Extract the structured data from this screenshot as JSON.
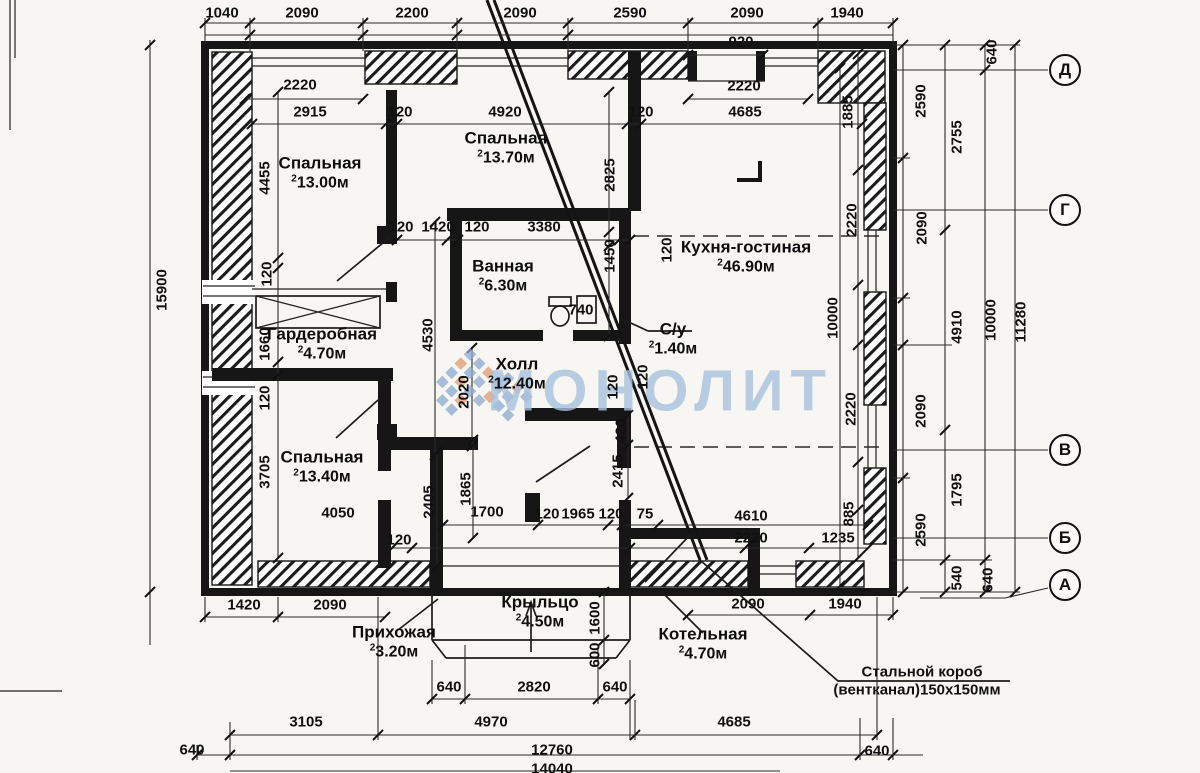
{
  "watermark": {
    "text": "МОНОЛИТ"
  },
  "annotation": {
    "line1": "Стальной короб",
    "line2": "(вентканал)150x150мм"
  },
  "colors": {
    "watermark": "#a9c2de",
    "logo_blue": "#8da9cf",
    "logo_orange": "#e09a74",
    "ink": "#161616"
  },
  "axes": [
    {
      "label": "Д",
      "x": 1065,
      "y": 70
    },
    {
      "label": "Г",
      "x": 1065,
      "y": 210
    },
    {
      "label": "В",
      "x": 1065,
      "y": 450
    },
    {
      "label": "Б",
      "x": 1065,
      "y": 538
    },
    {
      "label": "А",
      "x": 1065,
      "y": 585
    }
  ],
  "rooms": [
    {
      "name": "Спальная",
      "area": "13.00м",
      "x": 320,
      "y": 173
    },
    {
      "name": "Спальная",
      "area": "13.70м",
      "x": 506,
      "y": 148
    },
    {
      "name": "Кухня-гостиная",
      "area": "46.90м",
      "x": 746,
      "y": 257
    },
    {
      "name": "Ванная",
      "area": "6.30м",
      "x": 503,
      "y": 276
    },
    {
      "name": "С/у",
      "area": "1.40м",
      "x": 673,
      "y": 339
    },
    {
      "name": "Холл",
      "area": "12.40м",
      "x": 517,
      "y": 374
    },
    {
      "name": "Гардеробная",
      "area": "4.70м",
      "x": 322,
      "y": 344
    },
    {
      "name": "Спальная",
      "area": "13.40м",
      "x": 322,
      "y": 467
    },
    {
      "name": "Крыльцо",
      "area": "4.50м",
      "x": 540,
      "y": 612
    },
    {
      "name": "Прихожая",
      "area": "3.20м",
      "x": 394,
      "y": 642
    },
    {
      "name": "Котельная",
      "area": "4.70м",
      "x": 703,
      "y": 644
    }
  ],
  "dimension_labels": [
    {
      "t": "1040",
      "x": 222,
      "y": 13
    },
    {
      "t": "2090",
      "x": 302,
      "y": 13
    },
    {
      "t": "2200",
      "x": 412,
      "y": 13
    },
    {
      "t": "2090",
      "x": 520,
      "y": 13
    },
    {
      "t": "2590",
      "x": 630,
      "y": 13
    },
    {
      "t": "2090",
      "x": 747,
      "y": 13
    },
    {
      "t": "1940",
      "x": 847,
      "y": 13
    },
    {
      "t": "920",
      "x": 741,
      "y": 42
    },
    {
      "t": "2220",
      "x": 300,
      "y": 85
    },
    {
      "t": "2220",
      "x": 744,
      "y": 86
    },
    {
      "t": "2915",
      "x": 310,
      "y": 112
    },
    {
      "t": "120",
      "x": 400,
      "y": 112
    },
    {
      "t": "4920",
      "x": 505,
      "y": 112
    },
    {
      "t": "120",
      "x": 641,
      "y": 112
    },
    {
      "t": "4685",
      "x": 745,
      "y": 112
    },
    {
      "t": "1885",
      "x": 848,
      "y": 112,
      "r": 1
    },
    {
      "t": "640",
      "x": 992,
      "y": 52,
      "r": 1
    },
    {
      "t": "2590",
      "x": 921,
      "y": 101,
      "r": 1
    },
    {
      "t": "2755",
      "x": 957,
      "y": 137,
      "r": 1
    },
    {
      "t": "2090",
      "x": 922,
      "y": 228,
      "r": 1
    },
    {
      "t": "2220",
      "x": 852,
      "y": 220,
      "r": 1
    },
    {
      "t": "2825",
      "x": 610,
      "y": 175,
      "r": 1
    },
    {
      "t": "120",
      "x": 667,
      "y": 250,
      "r": 1
    },
    {
      "t": "15900",
      "x": 162,
      "y": 290,
      "r": 1
    },
    {
      "t": "4455",
      "x": 265,
      "y": 178,
      "r": 1
    },
    {
      "t": "120",
      "x": 267,
      "y": 274,
      "r": 1
    },
    {
      "t": "1660",
      "x": 265,
      "y": 344,
      "r": 1
    },
    {
      "t": "120",
      "x": 265,
      "y": 398,
      "r": 1
    },
    {
      "t": "3705",
      "x": 265,
      "y": 472,
      "r": 1
    },
    {
      "t": "120",
      "x": 401,
      "y": 227
    },
    {
      "t": "1420",
      "x": 438,
      "y": 227
    },
    {
      "t": "120",
      "x": 477,
      "y": 227
    },
    {
      "t": "3380",
      "x": 544,
      "y": 227
    },
    {
      "t": "1450",
      "x": 610,
      "y": 256,
      "r": 1
    },
    {
      "t": "740",
      "x": 581,
      "y": 310
    },
    {
      "t": "120",
      "x": 613,
      "y": 387,
      "r": 1
    },
    {
      "t": "120",
      "x": 643,
      "y": 377,
      "r": 1
    },
    {
      "t": "420",
      "x": 621,
      "y": 431,
      "r": 1
    },
    {
      "t": "2415",
      "x": 618,
      "y": 471,
      "r": 1
    },
    {
      "t": "2020",
      "x": 464,
      "y": 392,
      "r": 1
    },
    {
      "t": "4530",
      "x": 428,
      "y": 335,
      "r": 1
    },
    {
      "t": "4910",
      "x": 957,
      "y": 327,
      "r": 1
    },
    {
      "t": "10000",
      "x": 991,
      "y": 320,
      "r": 1
    },
    {
      "t": "11280",
      "x": 1021,
      "y": 322,
      "r": 1
    },
    {
      "t": "10000",
      "x": 833,
      "y": 318,
      "r": 1
    },
    {
      "t": "2220",
      "x": 851,
      "y": 409,
      "r": 1
    },
    {
      "t": "2090",
      "x": 921,
      "y": 411,
      "r": 1
    },
    {
      "t": "885",
      "x": 849,
      "y": 514,
      "r": 1
    },
    {
      "t": "1235",
      "x": 838,
      "y": 538
    },
    {
      "t": "4610",
      "x": 751,
      "y": 516
    },
    {
      "t": "2220",
      "x": 751,
      "y": 538
    },
    {
      "t": "4050",
      "x": 338,
      "y": 513
    },
    {
      "t": "2405",
      "x": 429,
      "y": 502,
      "r": 1
    },
    {
      "t": "1865",
      "x": 466,
      "y": 489,
      "r": 1
    },
    {
      "t": "1700",
      "x": 487,
      "y": 512
    },
    {
      "t": "120",
      "x": 547,
      "y": 514
    },
    {
      "t": "1965",
      "x": 578,
      "y": 514
    },
    {
      "t": "120",
      "x": 611,
      "y": 514
    },
    {
      "t": "75",
      "x": 645,
      "y": 514
    },
    {
      "t": "120",
      "x": 399,
      "y": 540
    },
    {
      "t": "1420",
      "x": 244,
      "y": 605
    },
    {
      "t": "2090",
      "x": 330,
      "y": 605
    },
    {
      "t": "2090",
      "x": 748,
      "y": 604
    },
    {
      "t": "1940",
      "x": 845,
      "y": 604
    },
    {
      "t": "640",
      "x": 449,
      "y": 687
    },
    {
      "t": "2820",
      "x": 534,
      "y": 687
    },
    {
      "t": "640",
      "x": 615,
      "y": 687
    },
    {
      "t": "1600",
      "x": 595,
      "y": 618,
      "r": 1
    },
    {
      "t": "600",
      "x": 595,
      "y": 655,
      "r": 1
    },
    {
      "t": "3105",
      "x": 306,
      "y": 722
    },
    {
      "t": "4970",
      "x": 491,
      "y": 722
    },
    {
      "t": "4685",
      "x": 734,
      "y": 722
    },
    {
      "t": "640",
      "x": 192,
      "y": 750
    },
    {
      "t": "12760",
      "x": 552,
      "y": 750
    },
    {
      "t": "640",
      "x": 877,
      "y": 751
    },
    {
      "t": "14040",
      "x": 552,
      "y": 769
    },
    {
      "t": "2590",
      "x": 921,
      "y": 530,
      "r": 1
    },
    {
      "t": "1795",
      "x": 957,
      "y": 490,
      "r": 1
    },
    {
      "t": "540",
      "x": 957,
      "y": 578,
      "r": 1
    },
    {
      "t": "640",
      "x": 988,
      "y": 580,
      "r": 1
    }
  ]
}
